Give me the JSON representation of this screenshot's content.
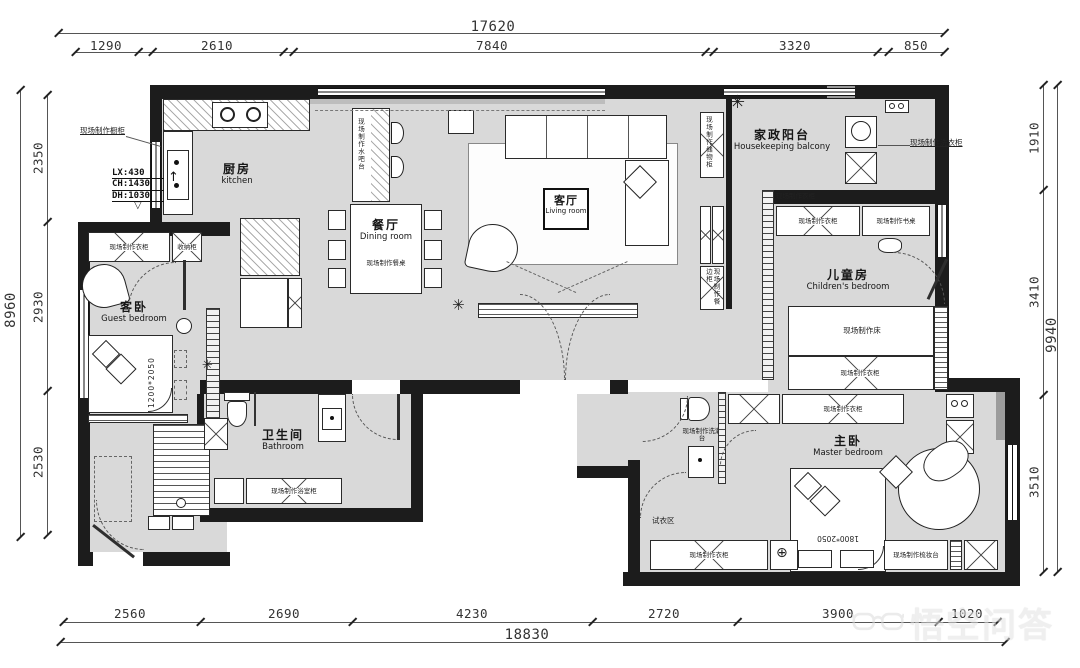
{
  "dims": {
    "top": {
      "total": "17620",
      "segments": [
        "1290",
        "2610",
        "7840",
        "3320",
        "850"
      ]
    },
    "bottom": {
      "total": "18830",
      "segments": [
        "2560",
        "2690",
        "4230",
        "2720",
        "3900",
        "1020"
      ]
    },
    "left": {
      "total": "8960",
      "segments": [
        "2350",
        "2930",
        "2530"
      ]
    },
    "right": {
      "total": "9940",
      "segments": [
        "1910",
        "3410",
        "3510"
      ]
    }
  },
  "rooms": {
    "kitchen": {
      "zh": "厨房",
      "en": "kitchen"
    },
    "dining": {
      "zh": "餐厅",
      "en": "Dining room"
    },
    "living": {
      "zh": "客厅",
      "en": "Living room"
    },
    "balcony": {
      "zh": "家政阳台",
      "en": "Housekeeping balcony"
    },
    "children": {
      "zh": "儿童房",
      "en": "Children's bedroom"
    },
    "guest": {
      "zh": "客卧",
      "en": "Guest bedroom"
    },
    "bath": {
      "zh": "卫生间",
      "en": "Bathroom"
    },
    "master": {
      "zh": "主卧",
      "en": "Master bedroom"
    }
  },
  "labels": {
    "wardrobe": "现场制作衣柜",
    "storage_small": "收纳柜",
    "water_bar": "现场制作水吧台",
    "dining_table": "现场制作餐桌",
    "bed": "现场制作床",
    "desk": "现场制作书桌",
    "dresser": "现场制作梳妆台",
    "vanity": "现场制作洗漱台",
    "bath_cabinet": "现场制作浴室柜",
    "sideboard": "现场制作餐边柜",
    "storage_cabinet": "现场制作储物柜",
    "cabinet_leader": "现场制作橱柜",
    "laundry_leader": "现场制作洗衣柜",
    "fitting_area": "试衣区",
    "guest_bed_size": "1200*2050",
    "master_bed_size": "1800*2050"
  },
  "notes": {
    "window": [
      "LX:430",
      "CH:1430",
      "DH:1030"
    ]
  },
  "watermark": {
    "brand": "悟空问答"
  }
}
